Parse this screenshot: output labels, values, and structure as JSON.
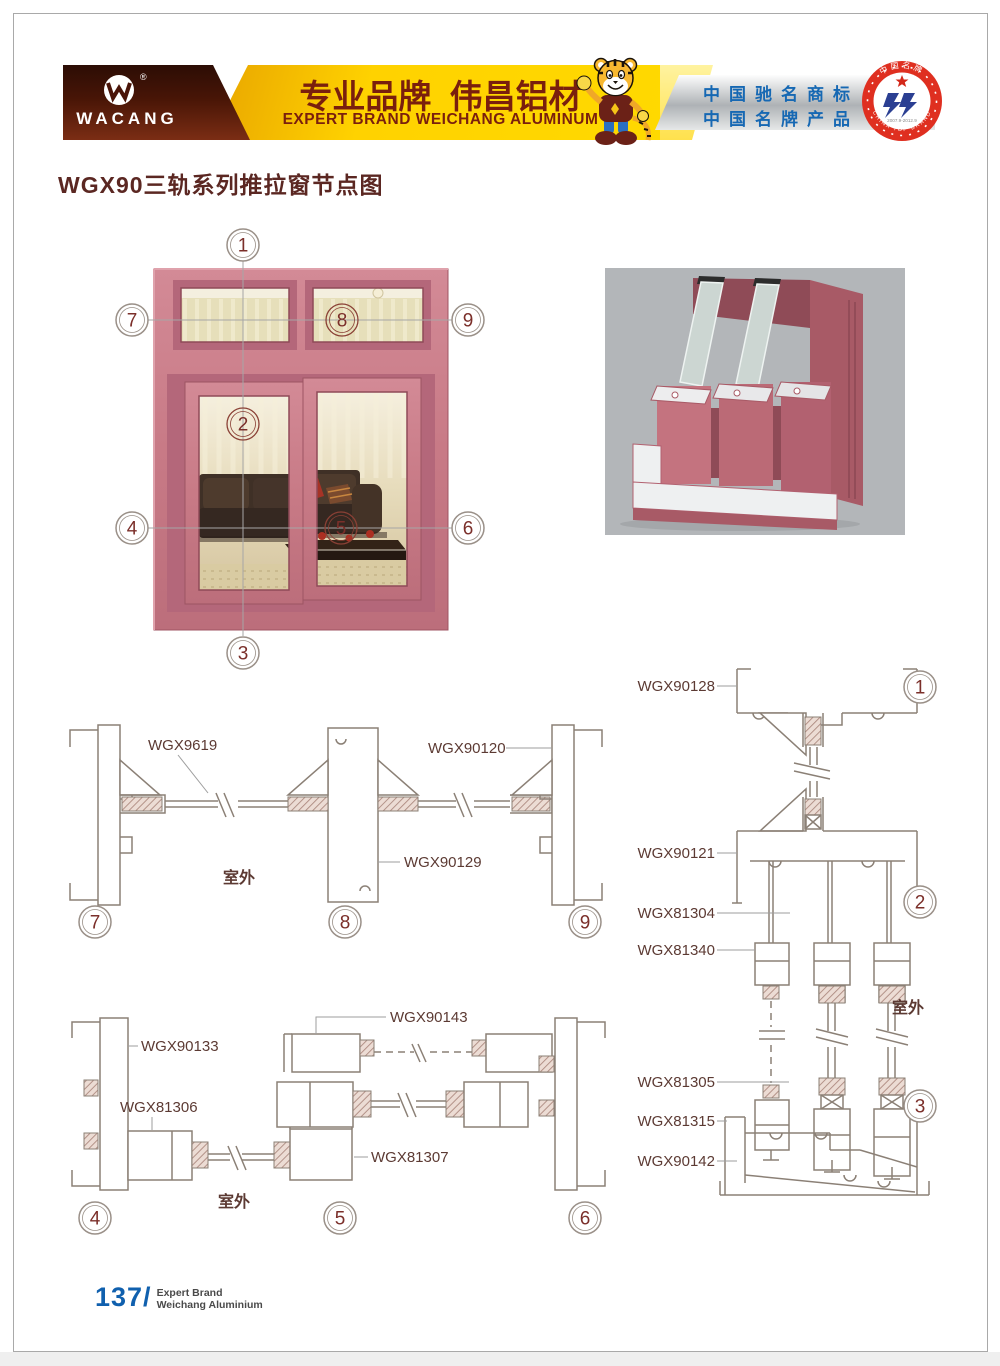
{
  "callouts": [
    "1",
    "2",
    "3",
    "4",
    "5",
    "6",
    "7",
    "8",
    "9"
  ],
  "header": {
    "brand": "WACANG",
    "registered_mark": "®",
    "banner_cn": "专业品牌  伟昌铝材",
    "banner_en": "EXPERT BRAND WEICHANG ALUMINUM",
    "honor_line1": "中国驰名商标",
    "honor_line2": "中国名牌产品",
    "badge_top": "中国名牌",
    "badge_bottom": "CHINA TOP BRAND",
    "badge_years": "2007.9-2012.9"
  },
  "title": "WGX90三轨系列推拉窗节点图",
  "drawings": {
    "top_horizontal": {
      "label_glass_bead": "WGX9619",
      "label_right_jamb": "WGX90120",
      "label_mullion": "WGX90129",
      "outdoor": "室外"
    },
    "bottom_horizontal": {
      "label_left_jamb": "WGX90133",
      "label_left_sash": "WGX81306",
      "label_top_sash": "WGX90143",
      "label_center_sash": "WGX81307",
      "outdoor": "室外"
    },
    "right_vertical": {
      "label_head": "WGX90128",
      "label_transom": "WGX90121",
      "label_sash_top": "WGX81304",
      "label_block": "WGX81340",
      "label_sash_mid": "WGX81305",
      "label_sash_bottom": "WGX81315",
      "label_sill": "WGX90142",
      "outdoor": "室外"
    }
  },
  "footer": {
    "page_number": "137/",
    "line1": "Expert Brand",
    "line2": "Weichang Aluminium"
  },
  "colors": {
    "frame_pink": "#c87a86",
    "title_maroon": "#5b2722",
    "banner_yellow": "#ffd200",
    "honor_blue": "#1668b3",
    "drawing_line": "#8b8076",
    "page_number_blue": "#1060ae",
    "badge_red": "#df2f20"
  }
}
